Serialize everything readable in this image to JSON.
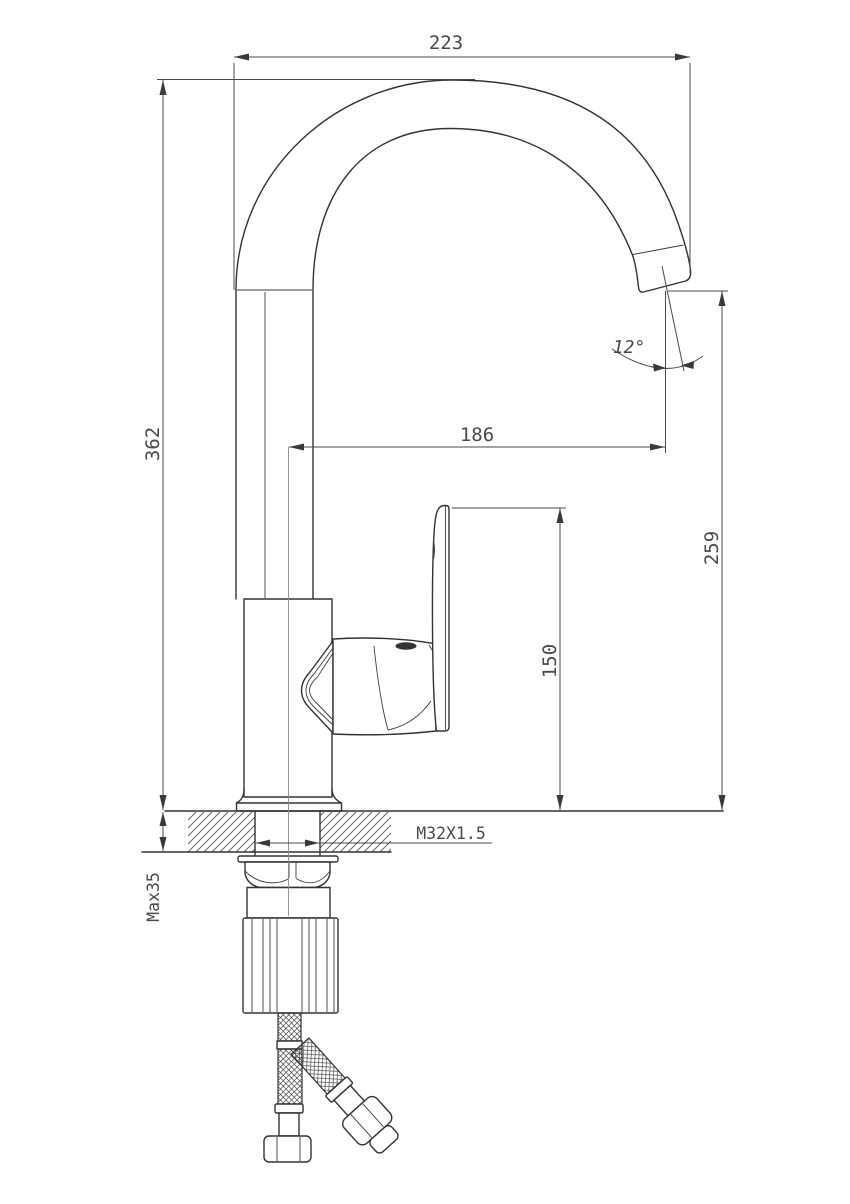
{
  "drawing": {
    "type": "technical-drawing",
    "subject": "single-lever kitchen faucet, side elevation with installation dimensions",
    "line_color": "#333333",
    "dimension_color": "#4a4a4a",
    "background": "#ffffff",
    "dimensions": {
      "overall_width": "223",
      "overall_height": "362",
      "spout_reach": "186",
      "outlet_height": "259",
      "handle_height": "150",
      "outlet_angle": "12°",
      "thread_spec": "M32X1.5",
      "max_deck_thickness": "Max35"
    }
  }
}
